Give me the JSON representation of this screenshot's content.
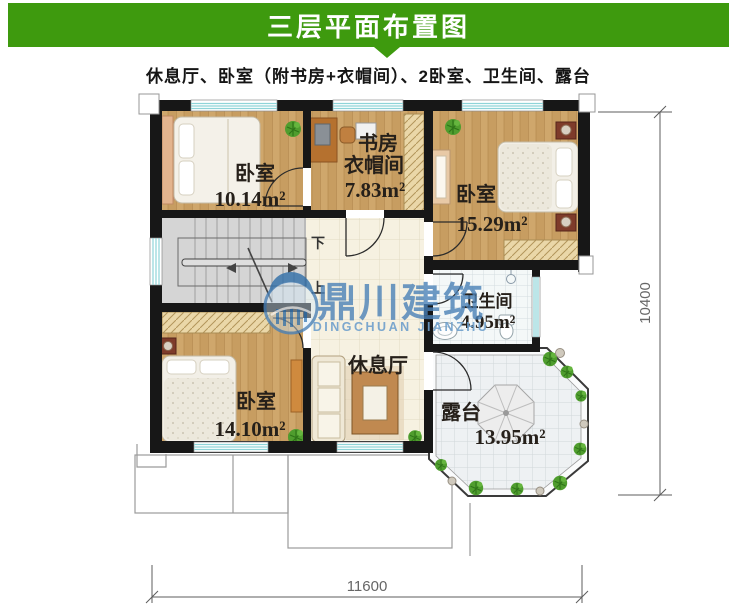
{
  "header": {
    "title": "三层平面布置图",
    "bg_color": "#3e9a0e"
  },
  "subtitle": "休息厅、卧室（附书房+衣帽间）、2卧室、卫生间、露台",
  "rooms": {
    "bedroom_top_left": {
      "name": "卧室",
      "area": "10.14m²"
    },
    "study": {
      "line1": "书房",
      "line2": "衣帽间",
      "area": "7.83m²"
    },
    "bedroom_top_right": {
      "name": "卧室",
      "area": "15.29m²"
    },
    "bathroom": {
      "name": "卫生间",
      "area": "4.95m²"
    },
    "lounge": {
      "name": "休息厅"
    },
    "bedroom_bottom_left": {
      "name": "卧室",
      "area": "14.10m²"
    },
    "terrace": {
      "name": "露台",
      "area": "13.95m²"
    }
  },
  "stairs": {
    "down": "下",
    "up": "上"
  },
  "dimensions": {
    "bottom": "11600",
    "right": "10400"
  },
  "watermark": {
    "cn": "鼎川建筑",
    "en": "DINGCHUAN JIANZHU"
  },
  "colors": {
    "header_bg": "#3e9a0e",
    "wall": "#171717",
    "window_accent": "#8fd4d8",
    "wood_floor": "#c79d61",
    "watermark_blue": "#4a81b7"
  }
}
